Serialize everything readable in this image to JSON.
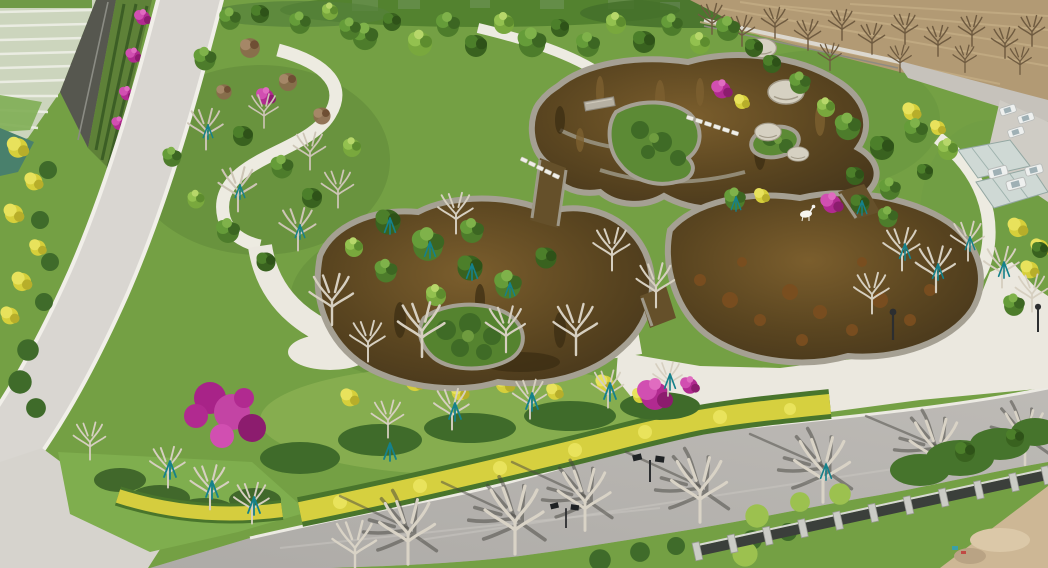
{
  "meta": {
    "type": "aerial-photograph",
    "description": "Drone aerial view of a newly landscaped park: a winding brown koi pond with stone rims and planted islands, white looping footpaths and a pale plaza, rows of young trees with teal support stakes, magenta bougainvillea and yellow flower hedges, a light concrete road on the left, an asphalt road with tree shadows along the bottom, farmland plots top-left, a dry brown field with bare trees top-right, a metal fence and bare dirt in the lower-right corner.",
    "width_px": 1048,
    "height_px": 568
  },
  "scene": {
    "regions": [
      {
        "name": "farmland-plots",
        "label": "striped farm paddies, top-left corner"
      },
      {
        "name": "boundary-wall",
        "label": "dark boundary wall with terraced flower beds"
      },
      {
        "name": "left-road",
        "label": "light concrete road running diagonally down the left side"
      },
      {
        "name": "park-interior",
        "label": "lawns, shrubs and young staked trees"
      },
      {
        "name": "pond-complex",
        "label": "three-lobed brown ornamental pond with stone rims"
      },
      {
        "name": "pond-islands",
        "label": "planted islands and mounds inside the pond"
      },
      {
        "name": "stepping-stones",
        "label": "white stepping-stone crossings"
      },
      {
        "name": "stone-bridge",
        "label": "small stone slab bridge"
      },
      {
        "name": "deer-sculpture",
        "label": "white deer sculpture on the pond shore"
      },
      {
        "name": "plaza",
        "label": "pale paved plaza south-east of the pond"
      },
      {
        "name": "looping-paths",
        "label": "white curving footpaths"
      },
      {
        "name": "yellow-hedge",
        "label": "golden hedge band along the bottom road"
      },
      {
        "name": "bougainvillea",
        "label": "magenta flower masses"
      },
      {
        "name": "bottom-road",
        "label": "asphalt road with tree shadows and solar lamps"
      },
      {
        "name": "roadside-trees",
        "label": "row of bare pale-trunk trees along the road"
      },
      {
        "name": "perimeter-fence",
        "label": "fence with concrete posts, lower right"
      },
      {
        "name": "dirt-corner",
        "label": "bare earth, bottom-right corner"
      },
      {
        "name": "dry-field",
        "label": "brown field with sparse bare trees, top-right"
      },
      {
        "name": "parked-vehicles",
        "label": "white cars and vans parked top-right"
      },
      {
        "name": "greenhouses",
        "label": "small glass structures on the right edge"
      },
      {
        "name": "solar-lamps",
        "label": "street lamps with solar panels"
      }
    ],
    "counts": {
      "pond_lobes": 3,
      "fence_posts": 11,
      "solar_lamps": 2,
      "pole_lamps": 2,
      "vehicles": 6
    }
  },
  "colors": {
    "park_base": "#74a044",
    "farmland": "#ccd5bd",
    "farm_row": "#eceee4",
    "field_brown": "#b29a74",
    "wall_dark": "#56574f",
    "terrace_green": "#5e8138",
    "concrete_road": "#d9d6d1",
    "asphalt_road": "#b3b0ac",
    "plaza": "#ebe8df",
    "path_white": "#edebe1",
    "stone_rim": "#a5a093",
    "water_dark": "#42331a",
    "water_mid": "#6b5226",
    "hedge_yellow": "#d6d03f",
    "hedge_under": "#49752c",
    "flower_magenta": "#b52a92",
    "flower_yellow": "#d6cf3b",
    "foliage_dark": "#3f6b2a",
    "foliage_mid": "#4d7c2b",
    "foliage_light": "#79a83d",
    "trunk_pale": "#d6cfc0",
    "field_tree": "#6f5b40",
    "stake_teal": "#15818b",
    "fence_dark": "#3b3f3b",
    "fence_post": "#cbccc6",
    "dirt": "#cdb795",
    "grass_bright": "#7fae4e",
    "shadow": "#45443e",
    "deer_white": "#f6f5f0"
  }
}
